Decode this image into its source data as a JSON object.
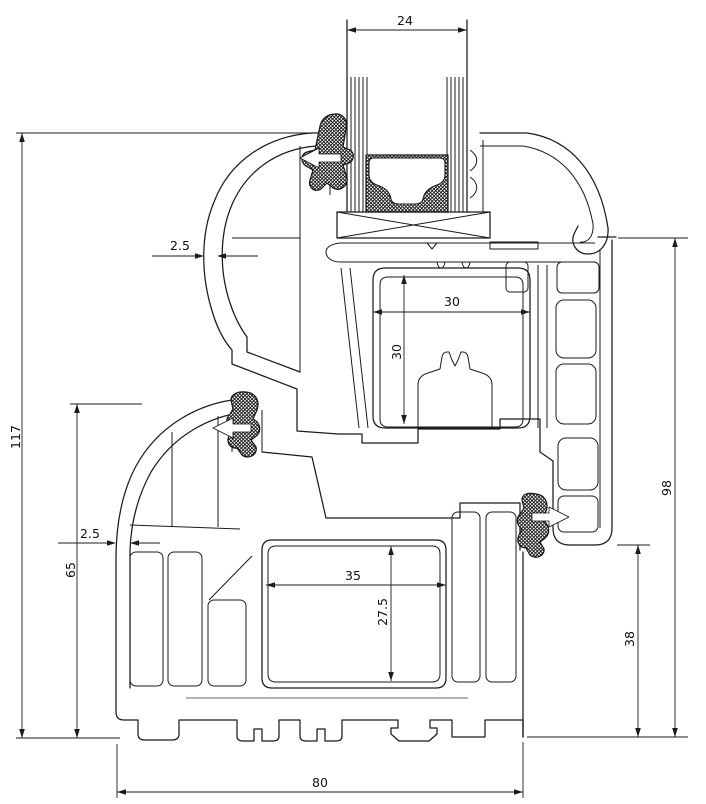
{
  "drawing": {
    "type": "technical cross-section",
    "subject": "PVC window frame and sash profile section with insulating glass unit",
    "units": "mm",
    "style": {
      "line_color": "#1b1b1b",
      "background": "#ffffff",
      "construction_line_gray": "#9a9a9a",
      "gasket_fill": "black-crosshatch"
    },
    "parts": [
      "sash-profile",
      "frame-profile",
      "glazing-unit",
      "glazing-bead",
      "spacer-bar",
      "glazing-gaskets",
      "weather-seal-gaskets",
      "steel-reinforcement-clip"
    ],
    "dimensions": {
      "glazing_unit_width": "24",
      "sash_wall_thickness": "2.5",
      "reinforcement_chamber_width": "30",
      "reinforcement_chamber_height": "30",
      "overall_height": "117",
      "frame_height": "65",
      "frame_wall_thickness": "2.5",
      "frame_chamber_width": "35",
      "frame_chamber_height": "27.5",
      "rebate_height": "38",
      "sash_height": "98",
      "profile_depth": "80"
    }
  }
}
